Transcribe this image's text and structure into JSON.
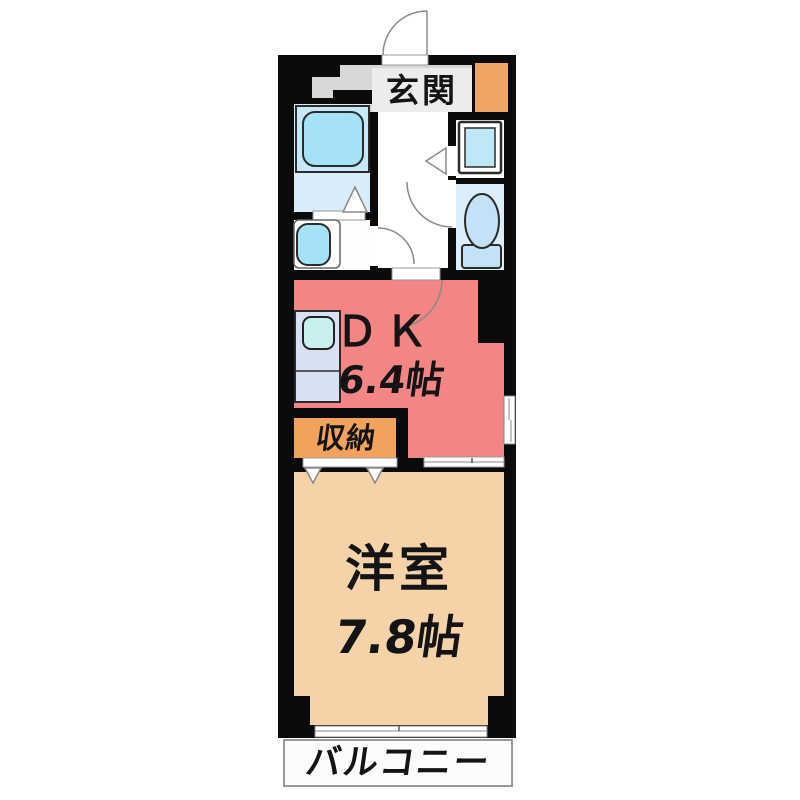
{
  "floor_plan": {
    "entrance": {
      "label": "玄関"
    },
    "dining_kitchen": {
      "label": "ＤＫ",
      "size": "6.4帖"
    },
    "storage": {
      "label": "収納"
    },
    "western_room": {
      "label": "洋室",
      "size": "7.8帖"
    },
    "balcony": {
      "label": "バルコニー"
    },
    "fixtures": [
      "entrance-door",
      "bathtub",
      "washbasin",
      "washing-machine-pan",
      "toilet",
      "kitchen-sink",
      "closet-doors",
      "sliding-window",
      "room-window"
    ],
    "colors": {
      "wall": "#0b0b0b",
      "dining_kitchen": "#f48585",
      "western_room": "#f5d2a8",
      "storage": "#f1a35b",
      "shoe_cabinet": "#f0a466",
      "entrance_floor": "#d8d8d8",
      "bathroom_floor": "#d8ecf9",
      "toilet_floor": "#daedfa",
      "fixture_blue": "#a5e1f7",
      "kitchen_counter": "#d8e1f1"
    }
  }
}
